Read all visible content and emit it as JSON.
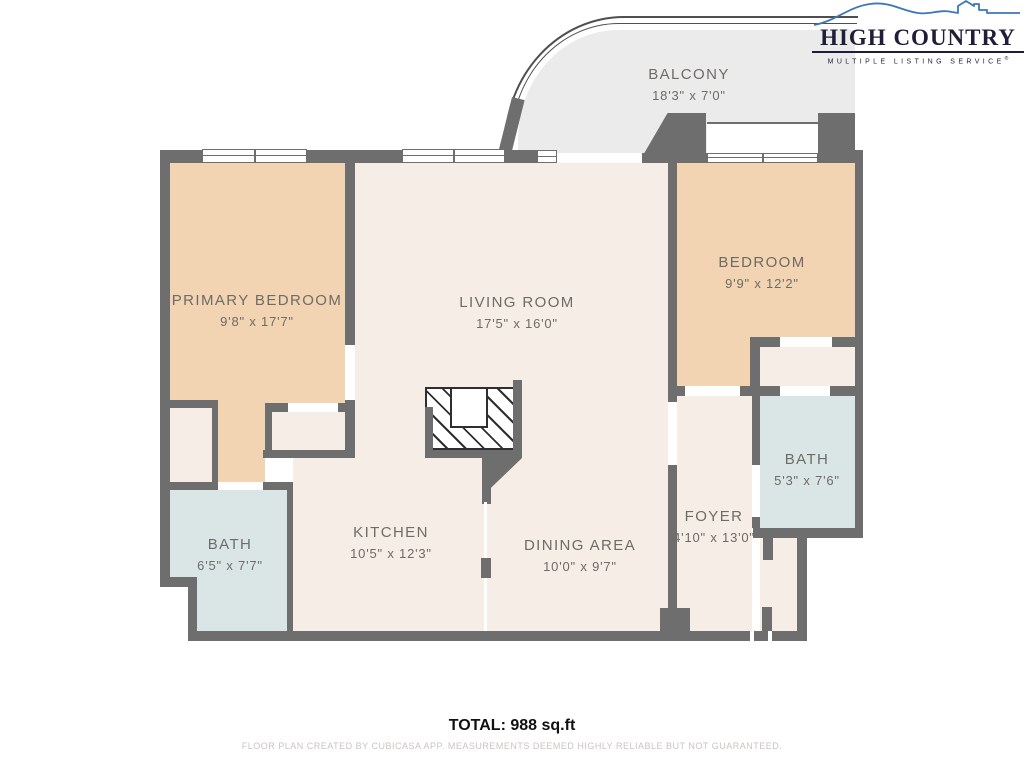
{
  "logo": {
    "title": "HIGH COUNTRY",
    "subtitle": "MULTIPLE LISTING SERVICE",
    "trademark": "®",
    "accent_color": "#3b78b5",
    "text_color": "#1e1e38"
  },
  "rooms": [
    {
      "name": "BALCONY",
      "dims": "18'3\" x 7'0\""
    },
    {
      "name": "PRIMARY BEDROOM",
      "dims": "9'8\" x 17'7\""
    },
    {
      "name": "LIVING ROOM",
      "dims": "17'5\" x 16'0\""
    },
    {
      "name": "BEDROOM",
      "dims": "9'9\" x 12'2\""
    },
    {
      "name": "BATH",
      "dims": "5'3\" x 7'6\""
    },
    {
      "name": "KITCHEN",
      "dims": "10'5\" x 12'3\""
    },
    {
      "name": "DINING AREA",
      "dims": "10'0\" x 9'7\""
    },
    {
      "name": "FOYER",
      "dims": "4'10\" x 13'0\""
    },
    {
      "name": "BATH",
      "dims": "6'5\" x 7'7\""
    }
  ],
  "footer": {
    "total": "TOTAL: 988 sq.ft",
    "disclaimer": "FLOOR PLAN CREATED BY CUBICASA APP. MEASUREMENTS DEEMED HIGHLY RELIABLE BUT NOT GUARANTEED."
  },
  "colors": {
    "wall": "#6e6e6e",
    "floor_cream": "#f5ede6",
    "floor_peach": "#f2d3b2",
    "floor_bath": "#d9e6e5",
    "floor_balcony": "#ebebeb"
  }
}
